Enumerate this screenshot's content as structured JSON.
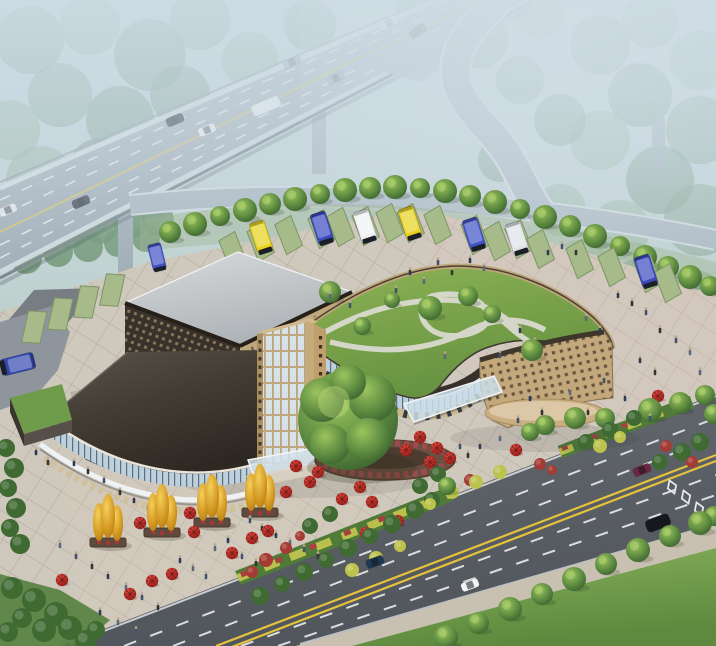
{
  "scene": {
    "alt": "Aerial architectural rendering of a bus terminal complex with a curved green-roof building, glass tower, elevated highway with exit ramp, bus parking pads, plaza with red umbrellas and golden trees, and a multi-lane boulevard",
    "palette": {
      "fog": "#cddbe4",
      "forest_far": "#7fa287",
      "forest_far2": "#8fb093",
      "forest_far3": "#6f9479",
      "forest_near": "#5e8a5f",
      "highway": "#a3afba",
      "highway_light": "#b4bfc8",
      "ramp": "#a9b4bd",
      "road": "#5a5f65",
      "sidewalk": "#c8c1b2",
      "plaza": "#cfc8bd",
      "plaza_dark_lane": "#787d83",
      "grass": "#78a24e",
      "pad": "#a6ba8a",
      "pad_edge": "#7f9566",
      "hwy_yellow": "#cfc068",
      "road_yellow": "#e4c23c",
      "white_line": "#eef0f2",
      "roof_gray": "#cdd0d3",
      "facade_dark": "#38322b",
      "lattice_dot": "#86755a",
      "tan": "#c5ab80",
      "glass": "#d7e2e8",
      "glass_blue": "#bcd0de",
      "green_roof": "#7ba449",
      "roof_path": "#dadacf",
      "fascia": "#36312b",
      "umbrella": "#c1332b",
      "gold": "#e3aa2e",
      "tree": "#4e7a3c",
      "bush_red": "#a43b34",
      "bush_yellow": "#bcc24e",
      "people_colors": [
        "#2c3a55",
        "#41506b",
        "#333333",
        "#5a6a7a",
        "#70513f"
      ]
    },
    "forest": [
      [
        30,
        40,
        34
      ],
      [
        90,
        25,
        30
      ],
      [
        150,
        55,
        36
      ],
      [
        60,
        95,
        32
      ],
      [
        10,
        130,
        30
      ],
      [
        120,
        120,
        34
      ],
      [
        200,
        20,
        30
      ],
      [
        250,
        60,
        28
      ],
      [
        180,
        95,
        30
      ],
      [
        310,
        25,
        26
      ],
      [
        360,
        55,
        24
      ],
      [
        420,
        20,
        26
      ],
      [
        480,
        40,
        28
      ],
      [
        540,
        15,
        24
      ],
      [
        600,
        45,
        30
      ],
      [
        650,
        20,
        28
      ],
      [
        700,
        60,
        30
      ],
      [
        640,
        95,
        32
      ],
      [
        700,
        130,
        34
      ],
      [
        600,
        140,
        30
      ],
      [
        660,
        180,
        34
      ],
      [
        700,
        220,
        36
      ],
      [
        620,
        230,
        30
      ],
      [
        560,
        120,
        26
      ],
      [
        520,
        80,
        24
      ],
      [
        40,
        180,
        34
      ],
      [
        100,
        170,
        32
      ],
      [
        160,
        160,
        30
      ],
      [
        20,
        230,
        30
      ],
      [
        80,
        215,
        28
      ],
      [
        140,
        205,
        26
      ],
      [
        580,
        270,
        30
      ],
      [
        640,
        290,
        32
      ],
      [
        695,
        300,
        30
      ],
      [
        560,
        210,
        26
      ],
      [
        500,
        160,
        22
      ]
    ],
    "near_forest": [
      [
        12,
        242,
        20
      ],
      [
        40,
        236,
        18
      ],
      [
        70,
        230,
        19
      ],
      [
        100,
        226,
        18
      ],
      [
        130,
        222,
        17
      ],
      [
        158,
        220,
        16
      ],
      [
        26,
        258,
        16
      ],
      [
        58,
        252,
        15
      ],
      [
        88,
        247,
        15
      ],
      [
        118,
        243,
        14
      ],
      [
        146,
        238,
        14
      ]
    ],
    "trees_back": [
      [
        170,
        232,
        11
      ],
      [
        195,
        224,
        12
      ],
      [
        220,
        216,
        10
      ],
      [
        245,
        210,
        12
      ],
      [
        270,
        204,
        11
      ],
      [
        295,
        199,
        12
      ],
      [
        320,
        194,
        10
      ],
      [
        345,
        190,
        12
      ],
      [
        370,
        188,
        11
      ],
      [
        395,
        187,
        12
      ],
      [
        420,
        188,
        10
      ],
      [
        445,
        191,
        12
      ],
      [
        470,
        196,
        11
      ],
      [
        495,
        202,
        12
      ],
      [
        520,
        209,
        10
      ],
      [
        545,
        217,
        12
      ],
      [
        570,
        226,
        11
      ],
      [
        595,
        236,
        12
      ],
      [
        620,
        246,
        10
      ],
      [
        645,
        257,
        12
      ],
      [
        668,
        267,
        11
      ],
      [
        690,
        277,
        12
      ],
      [
        710,
        286,
        10
      ]
    ],
    "trees_front": [
      [
        545,
        425,
        10
      ],
      [
        575,
        418,
        11
      ],
      [
        605,
        418,
        10
      ],
      [
        650,
        410,
        12
      ],
      [
        680,
        403,
        11
      ],
      [
        705,
        395,
        10
      ],
      [
        714,
        414,
        10
      ],
      [
        446,
        637,
        12
      ],
      [
        478,
        623,
        11
      ],
      [
        510,
        609,
        12
      ],
      [
        542,
        594,
        11
      ],
      [
        574,
        579,
        12
      ],
      [
        606,
        564,
        11
      ],
      [
        638,
        550,
        12
      ],
      [
        670,
        536,
        11
      ],
      [
        700,
        523,
        12
      ],
      [
        714,
        516,
        10
      ],
      [
        447,
        486,
        9
      ],
      [
        530,
        432,
        9
      ]
    ],
    "roof_trees": [
      [
        330,
        292,
        11
      ],
      [
        362,
        326,
        9
      ],
      [
        430,
        308,
        12
      ],
      [
        468,
        296,
        10
      ],
      [
        492,
        314,
        9
      ],
      [
        532,
        350,
        11
      ],
      [
        392,
        300,
        8
      ]
    ],
    "big_tree": {
      "x": 348,
      "y": 420,
      "r": 50
    },
    "pads": {
      "angled": [
        [
          233,
          252
        ],
        [
          261,
          243
        ],
        [
          289,
          236
        ],
        [
          322,
          230
        ],
        [
          341,
          228
        ],
        [
          366,
          227
        ],
        [
          390,
          224
        ],
        [
          411,
          224
        ],
        [
          438,
          226
        ],
        [
          475,
          236
        ],
        [
          497,
          242
        ],
        [
          519,
          240
        ],
        [
          541,
          250
        ],
        [
          580,
          260
        ],
        [
          612,
          268
        ],
        [
          648,
          274
        ],
        [
          668,
          284
        ]
      ],
      "left": [
        [
          34,
          328
        ],
        [
          60,
          315
        ],
        [
          86,
          303
        ],
        [
          112,
          291
        ]
      ]
    },
    "buses": [
      [
        261,
        237,
        "#e8d21c",
        -18,
        1
      ],
      [
        322,
        228,
        "#3a49c0",
        -18,
        1
      ],
      [
        365,
        226,
        "#eef1f2",
        -18,
        1
      ],
      [
        410,
        223,
        "#e8d21c",
        -18,
        1
      ],
      [
        474,
        234,
        "#4052c8",
        -18,
        1
      ],
      [
        517,
        238,
        "#dfe3e6",
        -18,
        1
      ],
      [
        646,
        271,
        "#3a49c0",
        -18,
        1
      ],
      [
        157,
        257,
        "#4052c8",
        -14,
        0.85
      ],
      [
        18,
        364,
        "#3448b0",
        76,
        1.05
      ]
    ],
    "highway_vehicles": [
      [
        "bus",
        "#e9edf0",
        266,
        106,
        -23,
        1
      ],
      [
        "car",
        "#23262b",
        175,
        120,
        -23,
        1
      ],
      [
        "car",
        "#f2f4f5",
        207,
        130,
        -23,
        1
      ],
      [
        "car",
        "#9aa4ac",
        292,
        62,
        -23,
        0.75
      ],
      [
        "car",
        "#8d98a2",
        336,
        78,
        -23,
        0.7
      ],
      [
        "car",
        "#f0f2f4",
        8,
        210,
        -23,
        0.9
      ],
      [
        "car",
        "#2b3038",
        81,
        202,
        -23,
        0.9
      ],
      [
        "car",
        "#eef0f2",
        389,
        23,
        -33,
        0.65
      ],
      [
        "car",
        "#343a44",
        418,
        31,
        -33,
        0.6
      ]
    ],
    "road_vehicles": [
      [
        "car",
        "#6e2740",
        642,
        470,
        -21,
        1
      ],
      [
        "suv",
        "#17181c",
        658,
        523,
        -21,
        1.15
      ],
      [
        "car",
        "#1e3a52",
        375,
        562,
        -21,
        1
      ],
      [
        "car",
        "#f2f3f4",
        470,
        585,
        -21,
        1
      ]
    ],
    "diamonds": [
      [
        672,
        487
      ],
      [
        686,
        497
      ],
      [
        699,
        509
      ],
      [
        711,
        521
      ]
    ],
    "umbrellas": [
      [
        420,
        437
      ],
      [
        437,
        448
      ],
      [
        406,
        450
      ],
      [
        430,
        462
      ],
      [
        360,
        487
      ],
      [
        342,
        499
      ],
      [
        372,
        502
      ],
      [
        318,
        472
      ],
      [
        296,
        466
      ],
      [
        310,
        482
      ],
      [
        286,
        492
      ],
      [
        140,
        523
      ],
      [
        190,
        513
      ],
      [
        194,
        532
      ],
      [
        62,
        580
      ],
      [
        152,
        581
      ],
      [
        130,
        594
      ],
      [
        172,
        574
      ],
      [
        232,
        553
      ],
      [
        252,
        538
      ],
      [
        268,
        531
      ],
      [
        398,
        521
      ],
      [
        366,
        533
      ],
      [
        450,
        458
      ],
      [
        516,
        450
      ],
      [
        658,
        396
      ]
    ],
    "gold_trees": [
      [
        108,
        520
      ],
      [
        162,
        510
      ],
      [
        212,
        500
      ],
      [
        260,
        490
      ]
    ],
    "bushes": {
      "green": [
        [
          6,
          448,
          9
        ],
        [
          14,
          468,
          10
        ],
        [
          8,
          488,
          9
        ],
        [
          16,
          508,
          10
        ],
        [
          10,
          528,
          9
        ],
        [
          20,
          544,
          10
        ],
        [
          12,
          588,
          11
        ],
        [
          34,
          600,
          12
        ],
        [
          56,
          614,
          12
        ],
        [
          22,
          618,
          10
        ],
        [
          44,
          630,
          12
        ],
        [
          70,
          628,
          12
        ],
        [
          8,
          632,
          10
        ],
        [
          86,
          641,
          11
        ],
        [
          96,
          630,
          9
        ],
        [
          415,
          510,
          9
        ],
        [
          432,
          500,
          8
        ],
        [
          392,
          524,
          9
        ],
        [
          370,
          536,
          8
        ],
        [
          348,
          548,
          9
        ],
        [
          326,
          560,
          8
        ],
        [
          304,
          572,
          9
        ],
        [
          282,
          584,
          8
        ],
        [
          260,
          596,
          9
        ],
        [
          586,
          442,
          8
        ],
        [
          610,
          430,
          8
        ],
        [
          634,
          418,
          8
        ],
        [
          682,
          452,
          9
        ],
        [
          700,
          442,
          9
        ],
        [
          660,
          462,
          8
        ],
        [
          438,
          474,
          8
        ],
        [
          420,
          486,
          8
        ],
        [
          310,
          526,
          8
        ],
        [
          330,
          514,
          8
        ]
      ],
      "red": [
        [
          266,
          560,
          7
        ],
        [
          286,
          548,
          6
        ],
        [
          252,
          572,
          6
        ],
        [
          666,
          446,
          6
        ],
        [
          692,
          462,
          6
        ],
        [
          540,
          464,
          6
        ],
        [
          470,
          480,
          6
        ],
        [
          300,
          536,
          5
        ],
        [
          552,
          470,
          5
        ]
      ],
      "yellow": [
        [
          452,
          492,
          7
        ],
        [
          476,
          482,
          7
        ],
        [
          500,
          472,
          7
        ],
        [
          430,
          504,
          6
        ],
        [
          352,
          570,
          7
        ],
        [
          376,
          558,
          7
        ],
        [
          400,
          546,
          6
        ],
        [
          600,
          446,
          7
        ],
        [
          620,
          437,
          6
        ]
      ]
    },
    "people": [
      [
        548,
        252,
        0
      ],
      [
        562,
        246,
        1
      ],
      [
        576,
        252,
        2
      ],
      [
        470,
        260,
        0
      ],
      [
        484,
        268,
        3
      ],
      [
        438,
        262,
        1
      ],
      [
        452,
        272,
        2
      ],
      [
        410,
        272,
        0
      ],
      [
        424,
        281,
        3
      ],
      [
        396,
        290,
        1
      ],
      [
        618,
        295,
        0
      ],
      [
        632,
        303,
        2
      ],
      [
        646,
        312,
        1
      ],
      [
        586,
        318,
        3
      ],
      [
        600,
        330,
        0
      ],
      [
        660,
        330,
        2
      ],
      [
        676,
        340,
        1
      ],
      [
        690,
        352,
        3
      ],
      [
        640,
        360,
        0
      ],
      [
        655,
        372,
        2
      ],
      [
        604,
        380,
        1
      ],
      [
        570,
        392,
        3
      ],
      [
        625,
        398,
        0
      ],
      [
        588,
        412,
        2
      ],
      [
        650,
        418,
        1
      ],
      [
        700,
        372,
        3
      ],
      [
        520,
        330,
        0
      ],
      [
        535,
        342,
        2
      ],
      [
        500,
        355,
        1
      ],
      [
        445,
        356,
        3
      ],
      [
        530,
        398,
        0
      ],
      [
        542,
        412,
        2
      ],
      [
        518,
        420,
        1
      ],
      [
        500,
        438,
        3
      ],
      [
        480,
        446,
        0
      ],
      [
        250,
        520,
        1
      ],
      [
        262,
        528,
        2
      ],
      [
        276,
        535,
        0
      ],
      [
        290,
        542,
        3
      ],
      [
        304,
        549,
        1
      ],
      [
        318,
        556,
        2
      ],
      [
        228,
        540,
        0
      ],
      [
        215,
        548,
        3
      ],
      [
        242,
        556,
        1
      ],
      [
        256,
        563,
        2
      ],
      [
        180,
        560,
        0
      ],
      [
        193,
        568,
        3
      ],
      [
        206,
        576,
        1
      ],
      [
        120,
        492,
        2
      ],
      [
        134,
        500,
        0
      ],
      [
        148,
        508,
        3
      ],
      [
        104,
        480,
        1
      ],
      [
        88,
        471,
        2
      ],
      [
        74,
        463,
        0
      ],
      [
        60,
        545,
        3
      ],
      [
        76,
        556,
        1
      ],
      [
        92,
        566,
        2
      ],
      [
        108,
        576,
        0
      ],
      [
        126,
        587,
        3
      ],
      [
        142,
        597,
        1
      ],
      [
        158,
        607,
        2
      ],
      [
        100,
        612,
        0
      ],
      [
        118,
        622,
        3
      ],
      [
        136,
        631,
        1
      ],
      [
        36,
        452,
        0
      ],
      [
        48,
        462,
        2
      ],
      [
        350,
        305,
        1
      ],
      [
        330,
        296,
        3
      ],
      [
        460,
        446,
        1
      ],
      [
        468,
        455,
        2
      ]
    ]
  }
}
